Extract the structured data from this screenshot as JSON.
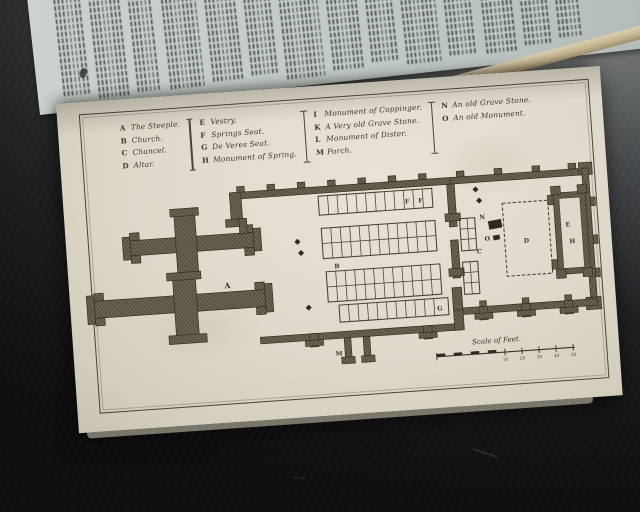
{
  "legend": {
    "columns": [
      {
        "items": [
          {
            "letter": "A",
            "label": "The Steeple."
          },
          {
            "letter": "B",
            "label": "Church."
          },
          {
            "letter": "C",
            "label": "Chancel."
          },
          {
            "letter": "D",
            "label": "Altar."
          }
        ]
      },
      {
        "items": [
          {
            "letter": "E",
            "label": "Vestry."
          },
          {
            "letter": "F",
            "label": "Springs Seat."
          },
          {
            "letter": "G",
            "label": "De Veres Seat."
          },
          {
            "letter": "H",
            "label": "Monument of Spring."
          }
        ]
      },
      {
        "items": [
          {
            "letter": "I",
            "label": "Monument of Coppinger."
          },
          {
            "letter": "K",
            "label": "A Very old Grave Stone."
          },
          {
            "letter": "L",
            "label": "Monument of Dister."
          },
          {
            "letter": "M",
            "label": "Porch."
          }
        ]
      },
      {
        "items": [
          {
            "letter": "N",
            "label": "An old Grave Stone."
          },
          {
            "letter": "O",
            "label": "An old Monument."
          }
        ]
      }
    ]
  },
  "plan": {
    "labels": {
      "steeple": "A",
      "church": "B",
      "chancel": "C",
      "altar": "D",
      "vestry": "E",
      "springs_seat_1": "F",
      "springs_seat_2": "F",
      "deveres_seat": "G",
      "monument_spring": "H",
      "porch": "M",
      "grave_stone": "N",
      "old_monument": "O"
    },
    "scale": {
      "label": "Scale of Feet.",
      "ticks": [
        "10",
        "20",
        "30",
        "40",
        "50"
      ]
    }
  },
  "colors": {
    "paper": "#ded9ca",
    "text_page_paper": "#c7cec9",
    "ink": "#3d372b",
    "wall_fill": "#6b6351",
    "background_dark": "#131314",
    "background_light": "#9a9d99"
  }
}
